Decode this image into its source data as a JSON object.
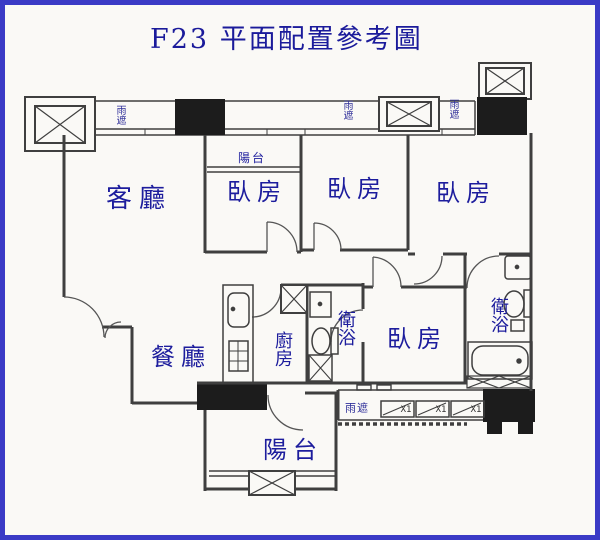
{
  "title": "F23 平面配置參考圖",
  "colors": {
    "border_blue": "#3b3bc6",
    "label_navy": "#1d1d9d",
    "wall_gray": "#3f3f3f",
    "column_black": "#1c1c1c",
    "paper": "#faf9f6"
  },
  "rooms": {
    "living": "客廳",
    "bedroom1": "臥房",
    "bedroom2": "臥房",
    "bedroom3": "臥房",
    "bedroom4": "臥房",
    "dining": "餐廳",
    "kitchen": "廚房",
    "bath_middle": "衛浴",
    "bath_right": "衛浴",
    "balcony_top": "陽台",
    "balcony_bottom": "陽台"
  },
  "canopies": {
    "top_left": "雨遮",
    "top_middle": "雨遮",
    "top_right": "雨遮",
    "bottom": "雨遮"
  },
  "ac_units": [
    {
      "label": "X1"
    },
    {
      "label": "X1"
    },
    {
      "label": "X1"
    }
  ]
}
